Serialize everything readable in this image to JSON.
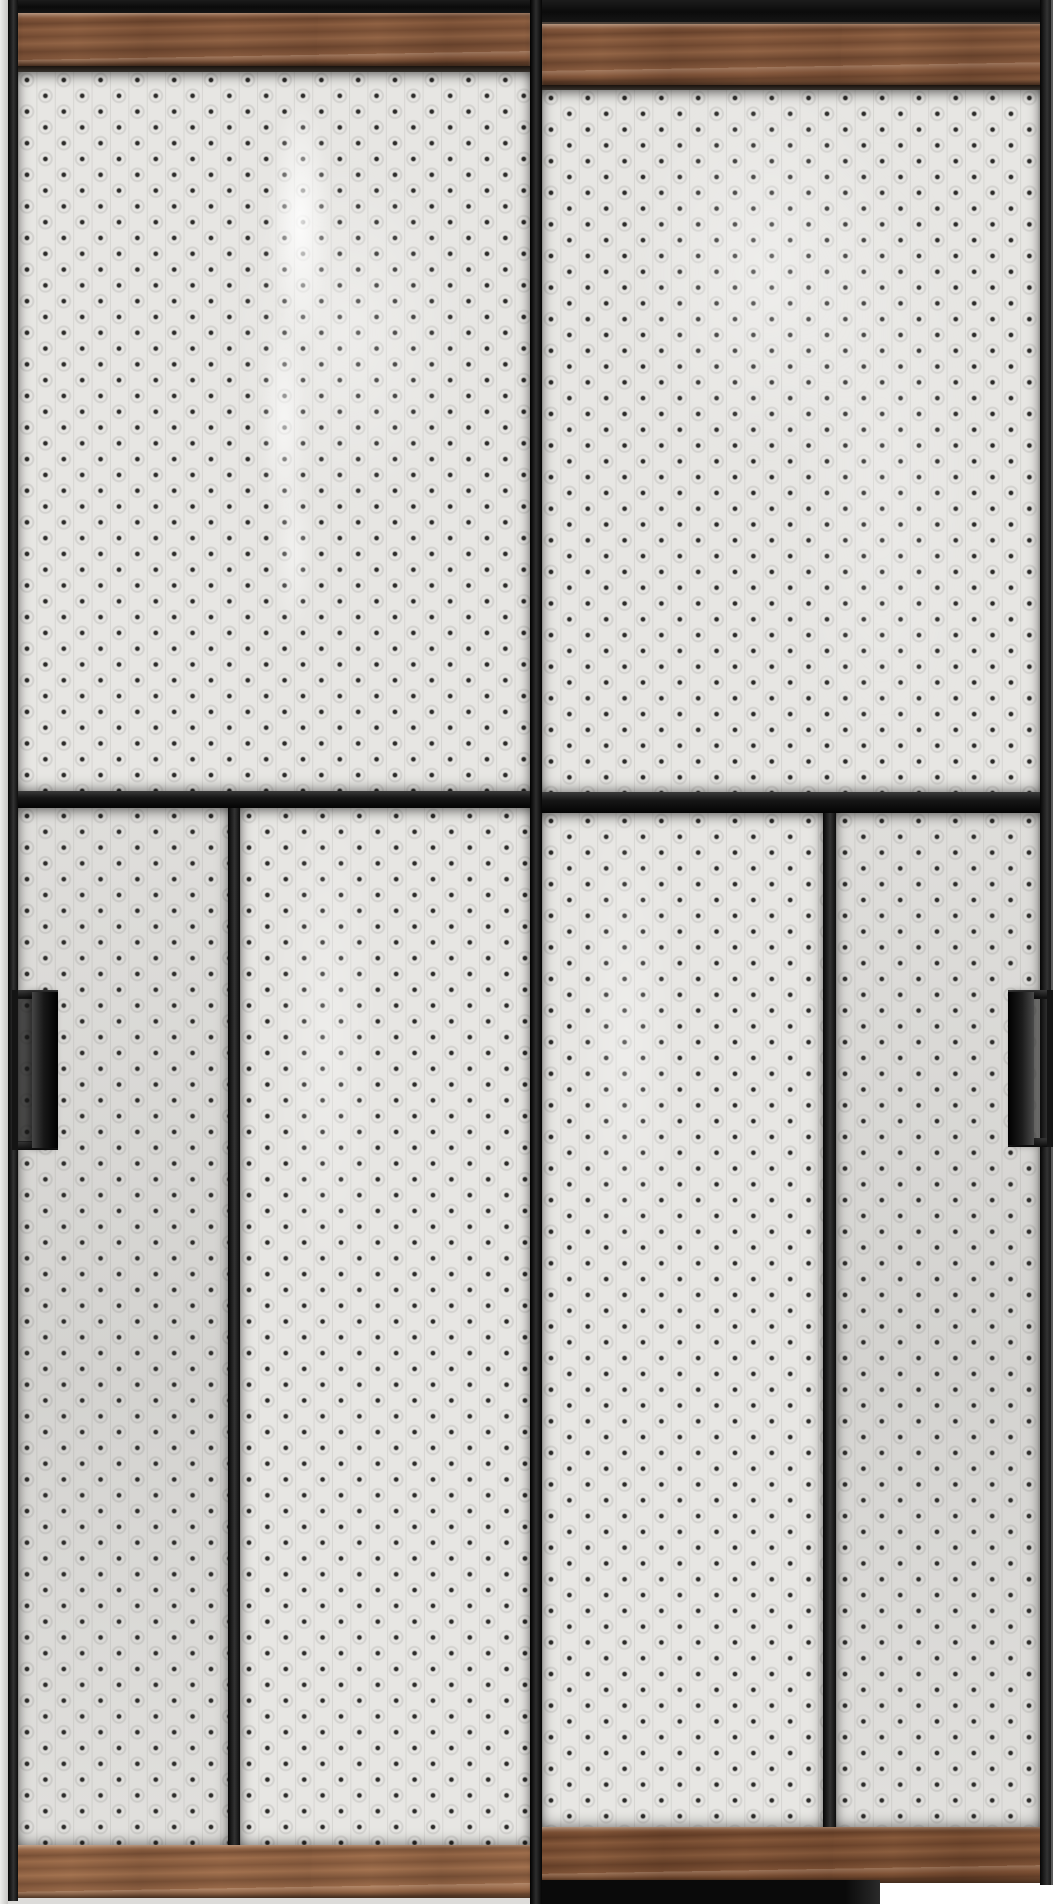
{
  "scene": {
    "subject": "two-panel sliding wardrobe doors, front view",
    "doors": 2,
    "left_door": {
      "label": "left sliding door",
      "top_rail": "walnut wood strip",
      "upper_section": "full-width dotted glass panel with glossy reflection streak",
      "middle_rail": "black horizontal crossbar",
      "lower_section": "two dotted glass panels split by black mullion",
      "bottom_rail": "light walnut wood strip",
      "handle": "black recessed vertical pull on left edge"
    },
    "right_door": {
      "label": "right sliding door",
      "top_rail": "walnut wood strip under black track",
      "upper_section": "full-width dotted glass panel",
      "middle_rail": "black horizontal crossbar",
      "lower_section": "two dotted glass panels split by black mullion",
      "bottom_rail": "dark walnut wood strip over black floor track",
      "handle": "black recessed vertical pull on right edge"
    },
    "pattern": "light textured panel with grid of small dark square dots and faint embossed circles"
  },
  "colors": {
    "frame_black": "#141414",
    "frame_deep": "#090909",
    "frame_highlight": "#3a3a3a",
    "outer_edge": "#d8d7d5",
    "wood_base": "#85583d",
    "wood_dark": "#5e3a26",
    "wood_light": "#a87e58",
    "wood_bottom_left": "#9a6a4a",
    "wood_bottom_right": "#7a4e33",
    "panel_base": "#e7e6e3",
    "panel_dot": "#2b2a28",
    "panel_ring": "#d3d2cf",
    "gloss": "#ffffff",
    "floor_light": "#f2f1ef"
  }
}
